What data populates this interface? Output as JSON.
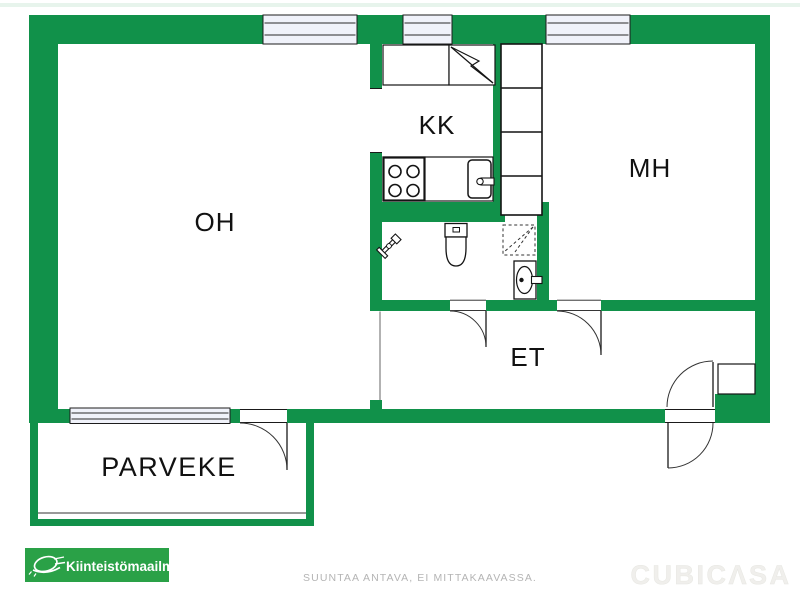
{
  "plan": {
    "rooms": [
      {
        "id": "oh",
        "label": "OH"
      },
      {
        "id": "kk",
        "label": "KK"
      },
      {
        "id": "mh",
        "label": "MH"
      },
      {
        "id": "et",
        "label": "ET"
      },
      {
        "id": "parveke",
        "label": "PARVEKE"
      }
    ],
    "fixtures": [
      "stove-icon",
      "kitchen-sink-icon",
      "fridge-icon",
      "counter",
      "closet-column",
      "toilet-icon",
      "shower-icon",
      "washbasin-icon",
      "water-valve-icon",
      "door-swing",
      "window",
      "entrance-double-door",
      "wall-niche"
    ]
  },
  "footer": {
    "brand_logo_text": "Kiinteistömaailma",
    "disclaimer": "SUUNTAA ANTAVA, EI MITTAKAAVASSA.",
    "watermark": "CUBICΛSA"
  },
  "colors": {
    "wall_green": "#11914a",
    "logo_green": "#2aa147",
    "window_fill": "#f0f2fa",
    "line_black": "#1c1c1c",
    "disclaimer_gray": "#b4b4b4",
    "watermark_gray": "#f0efec",
    "top_fade": "#dff0e6"
  }
}
